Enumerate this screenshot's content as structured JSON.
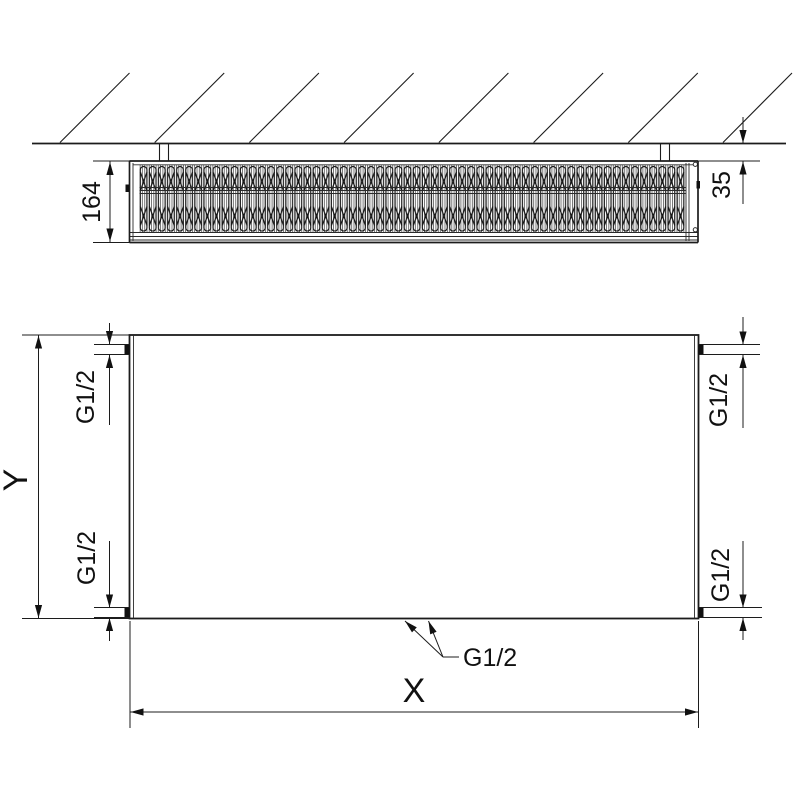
{
  "drawing": {
    "type": "panel-radiator technical drawing",
    "top_view": {
      "depth_dimension": "164",
      "wall_gap_dimension": "35"
    },
    "front_view": {
      "height_dimension_label": "Y",
      "width_dimension_label": "X",
      "connections": {
        "top_left": "G1/2",
        "bottom_left": "G1/2",
        "top_right": "G1/2",
        "bottom_right": "G1/2",
        "bottom_center": "G1/2"
      }
    },
    "colors": {
      "line_color": "#1c1c1c",
      "background": "#ffffff"
    }
  }
}
